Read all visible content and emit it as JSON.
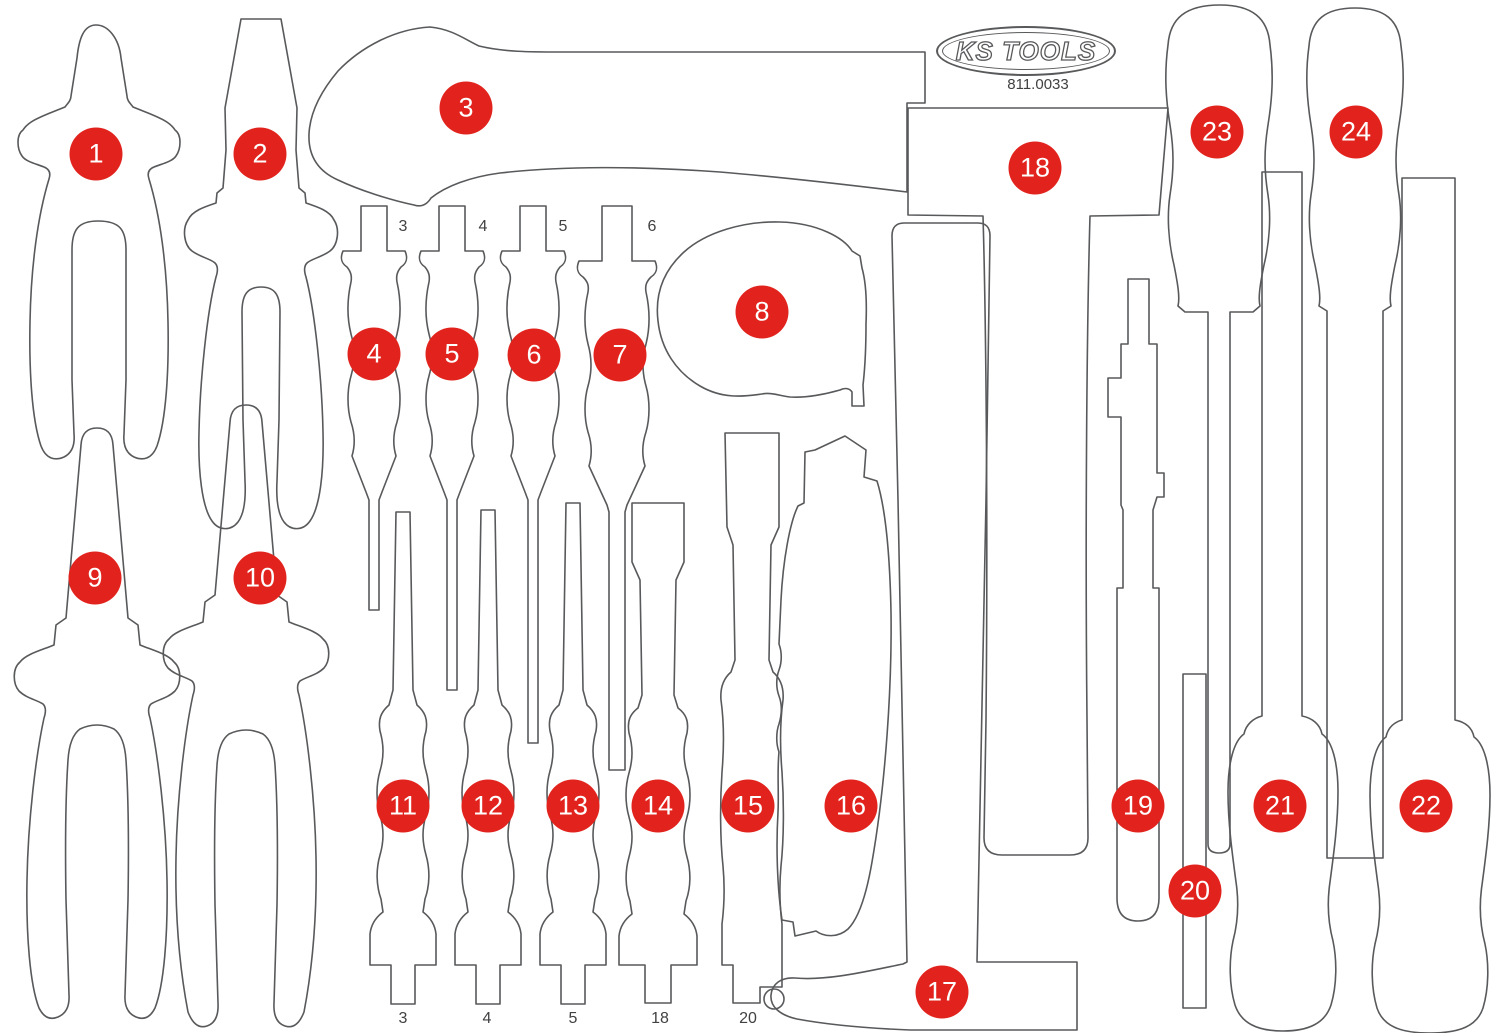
{
  "header": {
    "logo_text": "KS TOOLS",
    "part_number": "811.0033"
  },
  "colors": {
    "marker_red": "#e2231d",
    "outline_gray": "#58595b",
    "label_gray": "#414042",
    "background": "#ffffff"
  },
  "markers": [
    {
      "label": "1",
      "x": 96,
      "y": 154
    },
    {
      "label": "2",
      "x": 260,
      "y": 154
    },
    {
      "label": "3",
      "x": 466,
      "y": 108
    },
    {
      "label": "4",
      "x": 374,
      "y": 354
    },
    {
      "label": "5",
      "x": 452,
      "y": 354
    },
    {
      "label": "6",
      "x": 534,
      "y": 355
    },
    {
      "label": "7",
      "x": 620,
      "y": 355
    },
    {
      "label": "8",
      "x": 762,
      "y": 312
    },
    {
      "label": "9",
      "x": 95,
      "y": 578
    },
    {
      "label": "10",
      "x": 260,
      "y": 578
    },
    {
      "label": "11",
      "x": 403,
      "y": 806
    },
    {
      "label": "12",
      "x": 488,
      "y": 806
    },
    {
      "label": "13",
      "x": 573,
      "y": 806
    },
    {
      "label": "14",
      "x": 658,
      "y": 806
    },
    {
      "label": "15",
      "x": 748,
      "y": 806
    },
    {
      "label": "16",
      "x": 851,
      "y": 806
    },
    {
      "label": "17",
      "x": 942,
      "y": 992
    },
    {
      "label": "18",
      "x": 1035,
      "y": 168
    },
    {
      "label": "19",
      "x": 1138,
      "y": 806
    },
    {
      "label": "20",
      "x": 1195,
      "y": 891
    },
    {
      "label": "21",
      "x": 1280,
      "y": 806
    },
    {
      "label": "22",
      "x": 1426,
      "y": 806
    },
    {
      "label": "23",
      "x": 1217,
      "y": 132
    },
    {
      "label": "24",
      "x": 1356,
      "y": 132
    }
  ],
  "size_labels": {
    "top": [
      {
        "text": "3",
        "x": 403,
        "y": 227
      },
      {
        "text": "4",
        "x": 483,
        "y": 227
      },
      {
        "text": "5",
        "x": 563,
        "y": 227
      },
      {
        "text": "6",
        "x": 652,
        "y": 227
      }
    ],
    "bottom": [
      {
        "text": "3",
        "x": 403,
        "y": 1019
      },
      {
        "text": "4",
        "x": 487,
        "y": 1019
      },
      {
        "text": "5",
        "x": 573,
        "y": 1019
      },
      {
        "text": "18",
        "x": 660,
        "y": 1019
      },
      {
        "text": "20",
        "x": 748,
        "y": 1019
      }
    ]
  }
}
